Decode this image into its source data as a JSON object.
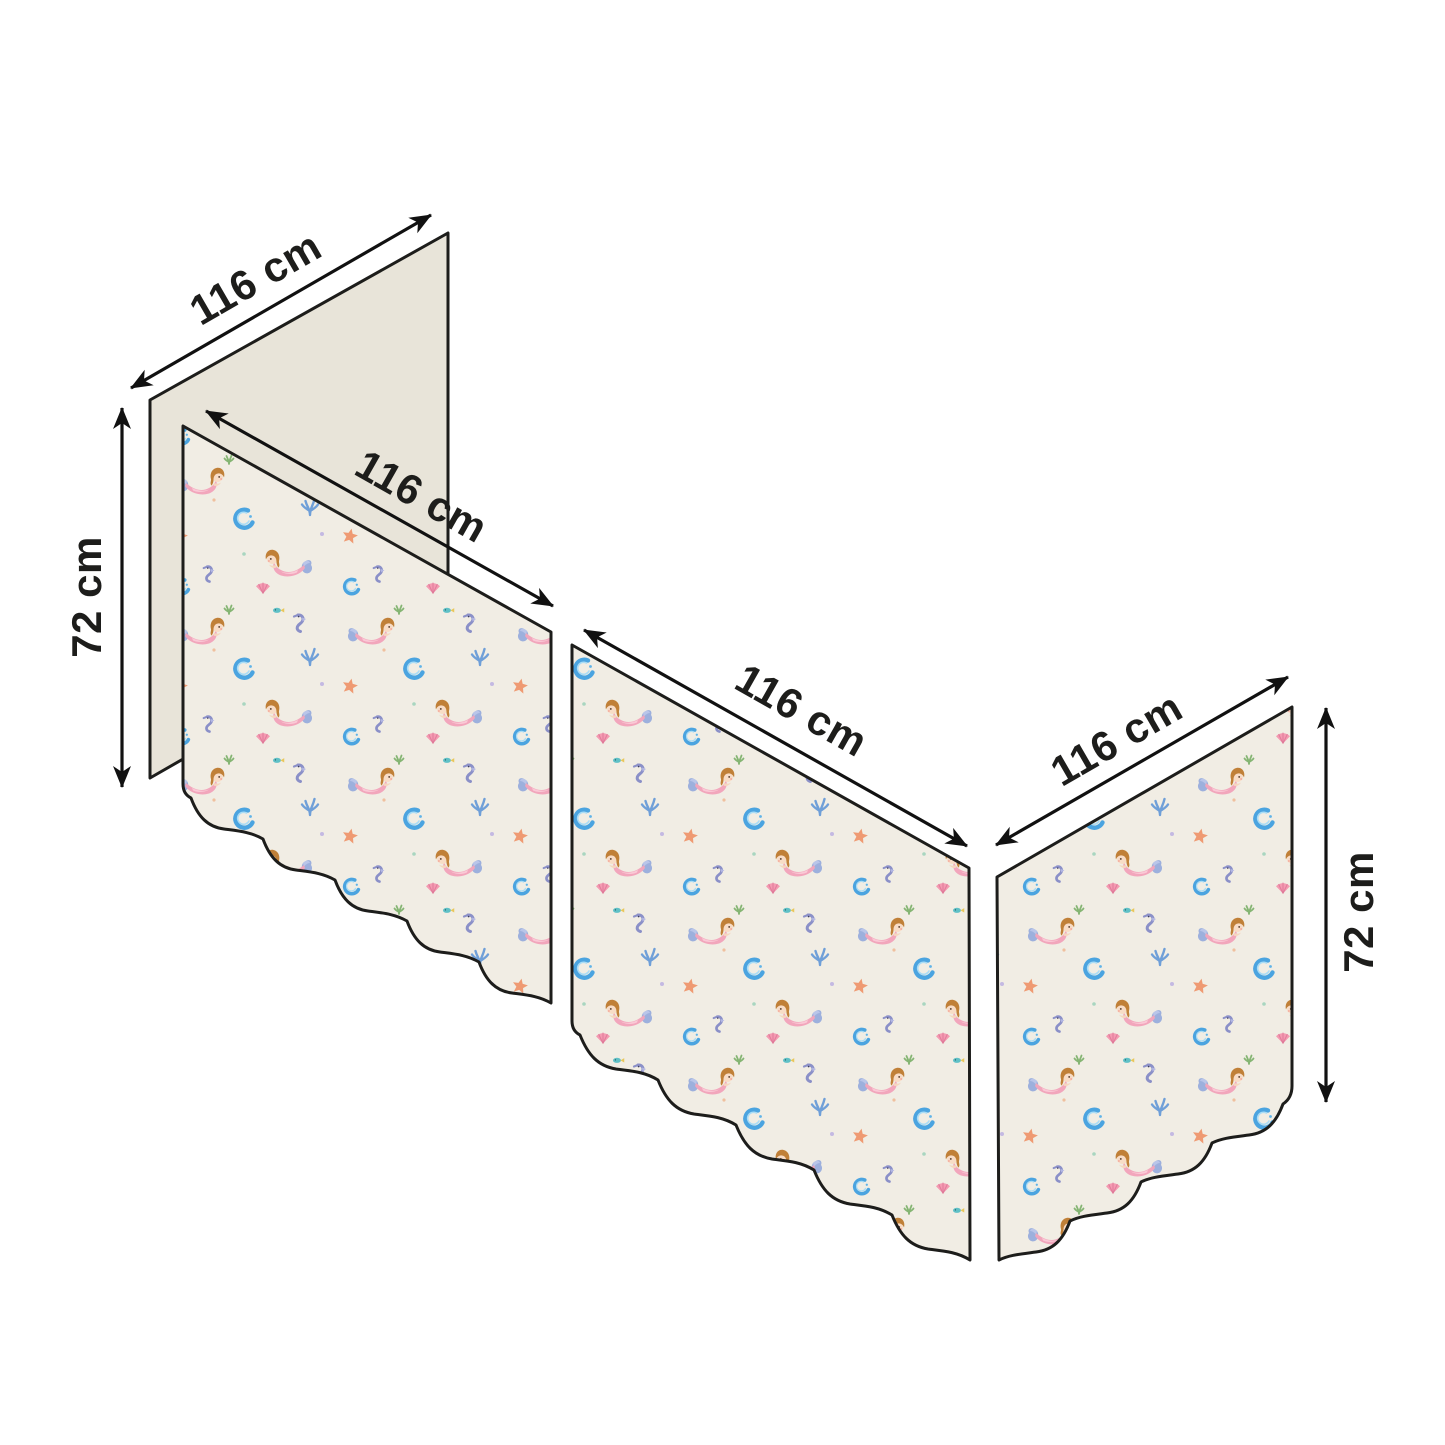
{
  "diagram": {
    "type": "product-dimension-diagram",
    "background": "#ffffff",
    "colors": {
      "outline": "#1d1d1b",
      "arrow": "#111111",
      "label_text": "#1d1d1b",
      "plain_panel_fill": "#e8e4d9",
      "pattern_background": "#f1ede4",
      "mermaid_hair": "#c08038",
      "mermaid_tail": "#f2a6bc",
      "mermaid_fin": "#9db0dd",
      "seahorse": "#8b90c8",
      "wave_crescent": "#4ba4e0",
      "starfish": "#ef9a72",
      "shell": "#f49ab2",
      "coral_sprig": "#6f9fd8",
      "fish": "#5fc0c6"
    },
    "panels": [
      {
        "id": "back-panel",
        "style": "plain",
        "width_label": "116 cm"
      },
      {
        "id": "left-front-panel",
        "style": "mermaid-pattern",
        "width_label": "116 cm"
      },
      {
        "id": "middle-panel",
        "style": "mermaid-pattern",
        "width_label": "116 cm"
      },
      {
        "id": "right-panel",
        "style": "mermaid-pattern",
        "width_label": "116 cm"
      }
    ],
    "height_labels": {
      "left": "72 cm",
      "right": "72 cm"
    },
    "pattern_motifs": [
      "mermaid",
      "seahorse",
      "starfish",
      "wave-crescent",
      "shell",
      "coral-sprig",
      "fish"
    ]
  }
}
